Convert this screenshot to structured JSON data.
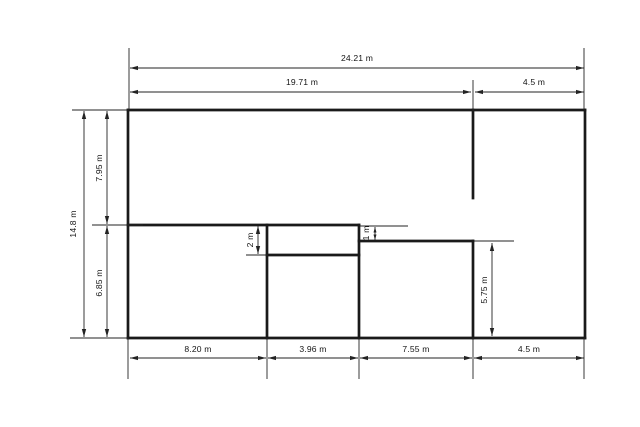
{
  "drawing": {
    "title": "floor-plan-with-dimensions",
    "units": "m",
    "background": "#ffffff",
    "wall_color": "#1a1a1a",
    "dimension_color": "#232323",
    "text_color": "#151515",
    "wall_stroke": 2.7,
    "dim_stroke": 0.9,
    "font_size": 8.6,
    "overall_width_label": "24.21 m",
    "overall_height_label": "14.8 m",
    "walls": [
      {
        "name": "outer-top",
        "x1": 128,
        "y1": 110,
        "x2": 585,
        "y2": 110
      },
      {
        "name": "outer-right",
        "x1": 585,
        "y1": 110,
        "x2": 585,
        "y2": 338
      },
      {
        "name": "outer-bottom",
        "x1": 128,
        "y1": 338,
        "x2": 585,
        "y2": 338
      },
      {
        "name": "outer-left",
        "x1": 128,
        "y1": 110,
        "x2": 128,
        "y2": 338
      },
      {
        "name": "top-partition",
        "x1": 473,
        "y1": 110,
        "x2": 473,
        "y2": 198
      },
      {
        "name": "middle-divider",
        "x1": 128,
        "y1": 225,
        "x2": 359,
        "y2": 225
      },
      {
        "name": "recess-bottom",
        "x1": 267,
        "y1": 255,
        "x2": 359,
        "y2": 255
      },
      {
        "name": "partition-left",
        "x1": 267,
        "y1": 225,
        "x2": 267,
        "y2": 338
      },
      {
        "name": "partition-center",
        "x1": 359,
        "y1": 225,
        "x2": 359,
        "y2": 338
      },
      {
        "name": "right-ledge",
        "x1": 359,
        "y1": 241,
        "x2": 473,
        "y2": 241
      },
      {
        "name": "partition-right",
        "x1": 473,
        "y1": 241,
        "x2": 473,
        "y2": 338
      }
    ],
    "extension_lines": [
      {
        "x1": 129,
        "y1": 48,
        "x2": 129,
        "y2": 110
      },
      {
        "x1": 584,
        "y1": 48,
        "x2": 584,
        "y2": 110
      },
      {
        "x1": 473,
        "y1": 80,
        "x2": 473,
        "y2": 112
      },
      {
        "x1": 72,
        "y1": 110,
        "x2": 128,
        "y2": 110
      },
      {
        "x1": 92,
        "y1": 225,
        "x2": 143,
        "y2": 225
      },
      {
        "x1": 70,
        "y1": 338,
        "x2": 128,
        "y2": 338
      },
      {
        "x1": 128,
        "y1": 338,
        "x2": 128,
        "y2": 379
      },
      {
        "x1": 267,
        "y1": 338,
        "x2": 267,
        "y2": 379
      },
      {
        "x1": 359,
        "y1": 338,
        "x2": 359,
        "y2": 379
      },
      {
        "x1": 473,
        "y1": 338,
        "x2": 473,
        "y2": 379
      },
      {
        "x1": 584,
        "y1": 338,
        "x2": 584,
        "y2": 379
      },
      {
        "x1": 246,
        "y1": 255,
        "x2": 268,
        "y2": 255
      },
      {
        "x1": 360,
        "y1": 226,
        "x2": 408,
        "y2": 226
      },
      {
        "x1": 474,
        "y1": 241,
        "x2": 514,
        "y2": 241
      }
    ],
    "dimensions": [
      {
        "label": "24.21 m",
        "dir": "h",
        "pos": 68,
        "from": 130,
        "to": 584,
        "lx": 357,
        "ly": 61
      },
      {
        "label": "19.71 m",
        "dir": "h",
        "pos": 92,
        "from": 130,
        "to": 471,
        "lx": 302,
        "ly": 85
      },
      {
        "label": "4.5 m",
        "dir": "h",
        "pos": 92,
        "from": 475,
        "to": 584,
        "lx": 534,
        "ly": 85
      },
      {
        "label": "14.8 m",
        "dir": "v",
        "pos": 84,
        "from": 111,
        "to": 337,
        "lx": 76,
        "ly": 224
      },
      {
        "label": "7.95 m",
        "dir": "v",
        "pos": 107,
        "from": 111,
        "to": 224,
        "lx": 102,
        "ly": 168
      },
      {
        "label": "6.85 m",
        "dir": "v",
        "pos": 107,
        "from": 226,
        "to": 337,
        "lx": 102,
        "ly": 283
      },
      {
        "label": "8.20 m",
        "dir": "h",
        "pos": 358,
        "from": 130,
        "to": 266,
        "lx": 198,
        "ly": 352
      },
      {
        "label": "3.96 m",
        "dir": "h",
        "pos": 358,
        "from": 268,
        "to": 358,
        "lx": 313,
        "ly": 352
      },
      {
        "label": "7.55 m",
        "dir": "h",
        "pos": 358,
        "from": 360,
        "to": 472,
        "lx": 416,
        "ly": 352
      },
      {
        "label": "4.5 m",
        "dir": "h",
        "pos": 358,
        "from": 474,
        "to": 584,
        "lx": 529,
        "ly": 352
      },
      {
        "label": "2 m",
        "dir": "v",
        "pos": 258,
        "from": 226,
        "to": 254,
        "lx": 253,
        "ly": 240
      },
      {
        "label": "1 m",
        "dir": "v",
        "pos": 375,
        "from": 227,
        "to": 240,
        "lx": 369,
        "ly": 233
      },
      {
        "label": "5.75 m",
        "dir": "v",
        "pos": 492,
        "from": 243,
        "to": 336,
        "lx": 487,
        "ly": 290
      }
    ]
  }
}
